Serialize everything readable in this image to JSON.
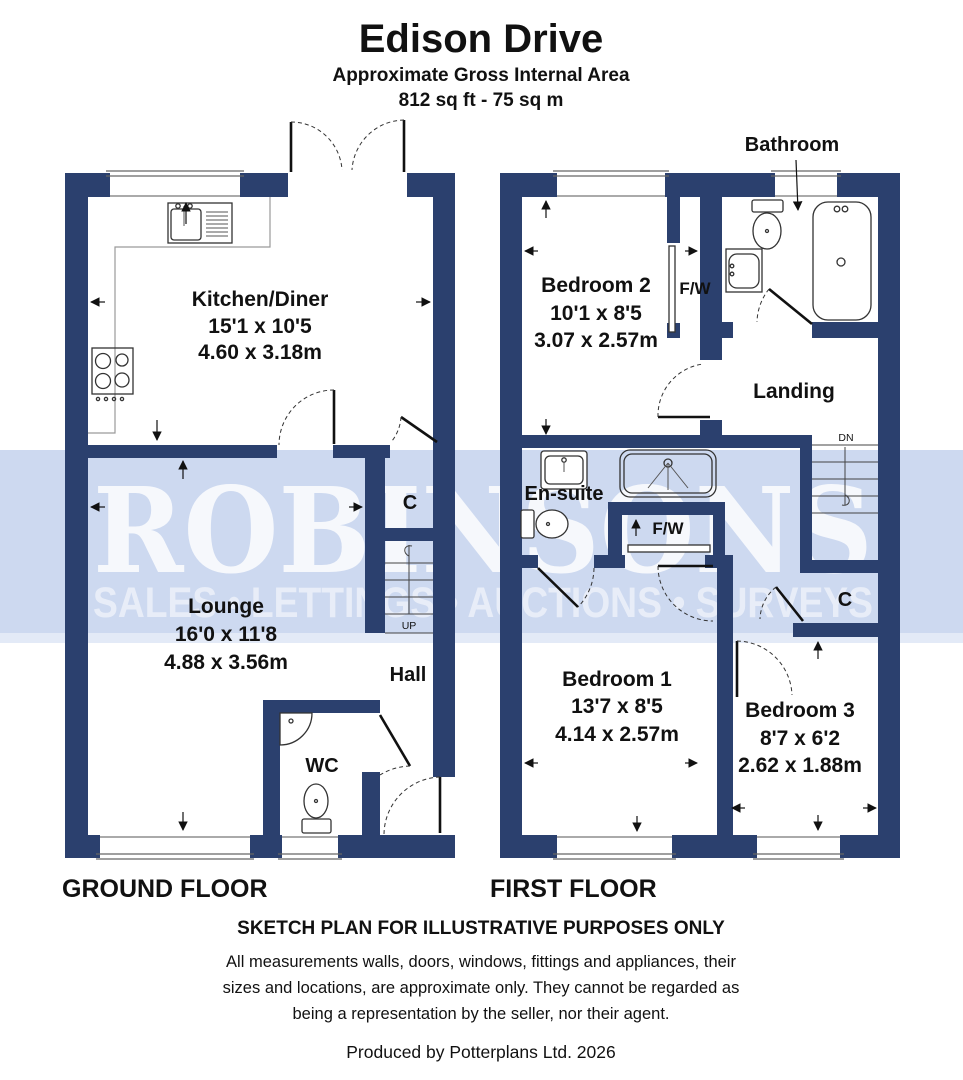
{
  "header": {
    "title": "Edison Drive",
    "subtitle": "Approximate Gross Internal Area",
    "area": "812 sq ft - 75 sq m"
  },
  "watermark": {
    "brand": "ROBINSONS",
    "tagline": "SALES • LETTINGS • AUCTIONS • SURVEYS"
  },
  "colors": {
    "wall": "#2b406e",
    "watermark_band": "#cdd9f0",
    "watermark_band_light": "#e3eaf7",
    "watermark_text": "#ffffff",
    "background": "#ffffff"
  },
  "ground_floor": {
    "label": "GROUND FLOOR",
    "kitchen": {
      "name": "Kitchen/Diner",
      "imperial": "15'1 x 10'5",
      "metric": "4.60 x 3.18m"
    },
    "lounge": {
      "name": "Lounge",
      "imperial": "16'0 x 11'8",
      "metric": "4.88 x 3.56m"
    },
    "hall": "Hall",
    "wc": "WC",
    "cupboard": "C",
    "stairs": "UP"
  },
  "first_floor": {
    "label": "FIRST FLOOR",
    "bedroom1": {
      "name": "Bedroom 1",
      "imperial": "13'7 x 8'5",
      "metric": "4.14 x 2.57m"
    },
    "bedroom2": {
      "name": "Bedroom 2",
      "imperial": "10'1 x 8'5",
      "metric": "3.07 x 2.57m"
    },
    "bedroom3": {
      "name": "Bedroom 3",
      "imperial": "8'7 x 6'2",
      "metric": "2.62 x 1.88m"
    },
    "bathroom": "Bathroom",
    "ensuite": "En-suite",
    "landing": "Landing",
    "fitted_wardrobe": "F/W",
    "cupboard": "C",
    "stairs": "DN"
  },
  "footer": {
    "sketch_note": "SKETCH PLAN FOR ILLUSTRATIVE PURPOSES ONLY",
    "disclaimer_line1": "All measurements walls, doors, windows, fittings and appliances, their",
    "disclaimer_line2": "sizes and locations, are approximate only. They cannot be regarded as",
    "disclaimer_line3": "being a representation by the seller, nor their agent.",
    "produced_by": "Produced by Potterplans Ltd. 2026"
  }
}
